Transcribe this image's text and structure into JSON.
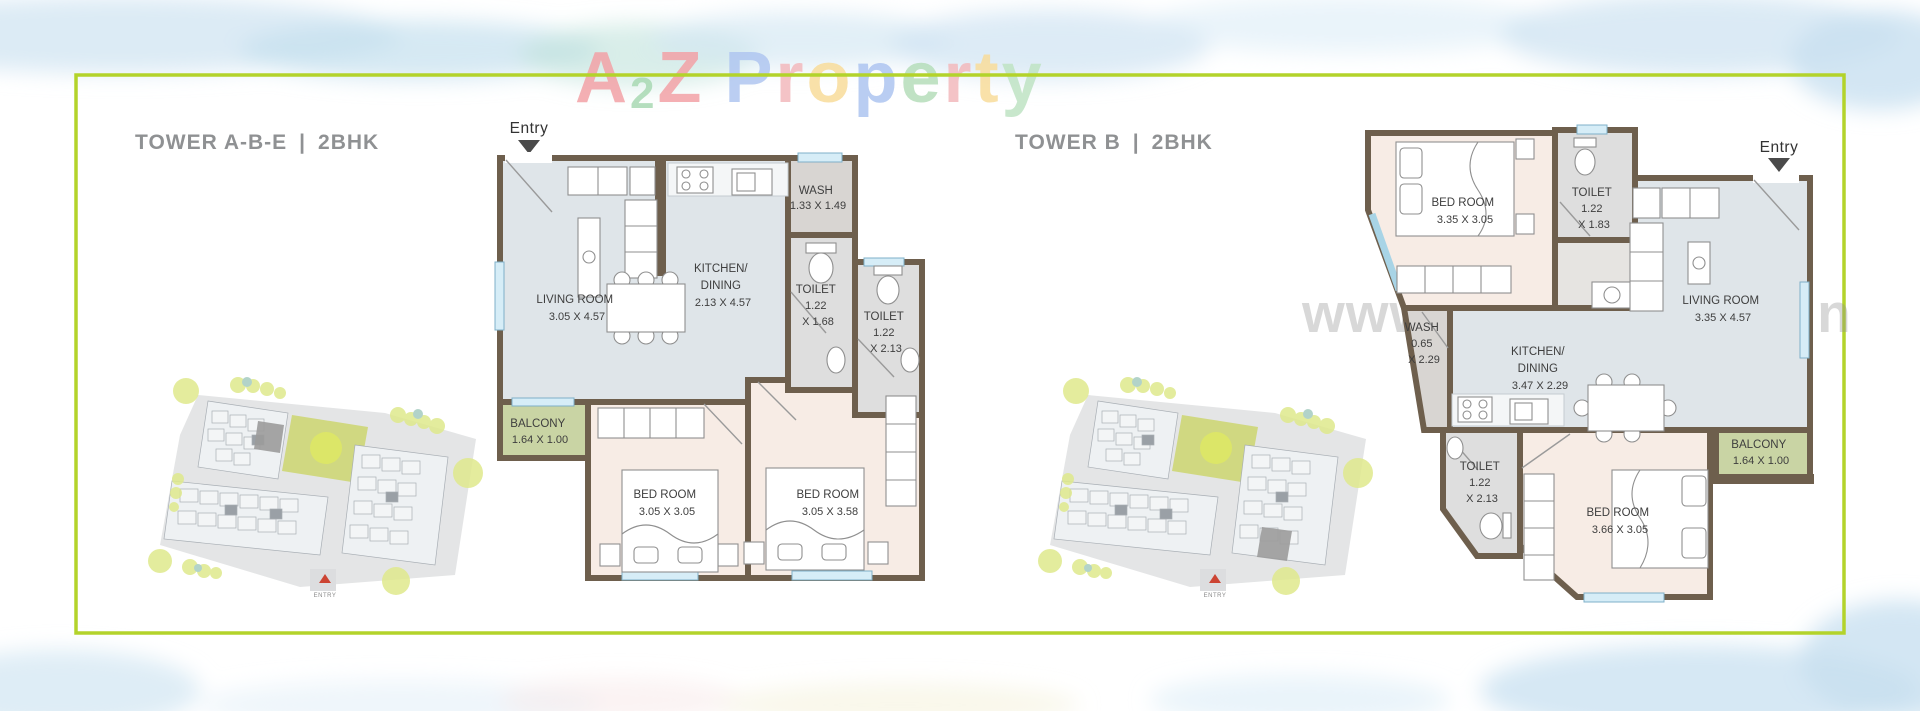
{
  "logo": {
    "a2z": [
      {
        "char": "A",
        "color": "#f2a2a6"
      },
      {
        "char": "2",
        "color": "#a9d9b3"
      },
      {
        "char": "Z",
        "color": "#f2a2a6"
      }
    ],
    "property": [
      {
        "char": "P",
        "color": "#b0c6f0"
      },
      {
        "char": "r",
        "color": "#f3b9bd"
      },
      {
        "char": "o",
        "color": "#f8dc9a"
      },
      {
        "char": "p",
        "color": "#adc5f0"
      },
      {
        "char": "e",
        "color": "#b5ddba"
      },
      {
        "char": "r",
        "color": "#f3b9bd"
      },
      {
        "char": "t",
        "color": "#f8dc9a"
      },
      {
        "char": "y",
        "color": "#bfe3c4"
      }
    ]
  },
  "watermark": {
    "text": "www.A2ZProperty.in"
  },
  "site": {
    "entry_label": "ENTRY"
  },
  "colors": {
    "frame_border": "#b3d32b",
    "wall": "#6e5f4d",
    "living_floor": "#dfe5e9",
    "bedroom_floor": "#f7ece5",
    "toilet_floor": "#dedede",
    "balcony_floor": "#c9d4a4"
  },
  "left_plan": {
    "title": {
      "name": "TOWER A-B-E",
      "sep": "|",
      "type": "2BHK"
    },
    "entry_label": "Entry",
    "rooms": {
      "living": {
        "name": "LIVING ROOM",
        "dims": "3.05 X 4.57"
      },
      "kitchen": {
        "name": "KITCHEN/",
        "name2": "DINING",
        "dims": "2.13 X 4.57"
      },
      "wash": {
        "name": "WASH",
        "dims": "1.33 X 1.49"
      },
      "toilet1": {
        "name": "TOILET",
        "dims": "1.22",
        "dims2": "X 1.68"
      },
      "toilet2": {
        "name": "TOILET",
        "dims": "1.22",
        "dims2": "X 2.13"
      },
      "balcony": {
        "name": "BALCONY",
        "dims": "1.64 X 1.00"
      },
      "bed1": {
        "name": "BED ROOM",
        "dims": "3.05 X 3.05"
      },
      "bed2": {
        "name": "BED ROOM",
        "dims": "3.05 X 3.58"
      }
    }
  },
  "right_plan": {
    "title": {
      "name": "TOWER B",
      "sep": "|",
      "type": "2BHK"
    },
    "entry_label": "Entry",
    "rooms": {
      "bed1": {
        "name": "BED ROOM",
        "dims": "3.35 X 3.05"
      },
      "toilet1": {
        "name": "TOILET",
        "dims": "1.22",
        "dims2": "X 1.83"
      },
      "living": {
        "name": "LIVING ROOM",
        "dims": "3.35 X 4.57"
      },
      "wash": {
        "name": "WASH",
        "dims": "0.65",
        "dims2": "X 2.29"
      },
      "kitchen": {
        "name": "KITCHEN/",
        "name2": "DINING",
        "dims": "3.47 X 2.29"
      },
      "toilet2": {
        "name": "TOILET",
        "dims": "1.22",
        "dims2": "X 2.13"
      },
      "bed2": {
        "name": "BED ROOM",
        "dims": "3.66 X 3.05"
      },
      "balcony": {
        "name": "BALCONY",
        "dims": "1.64 X 1.00"
      }
    }
  }
}
